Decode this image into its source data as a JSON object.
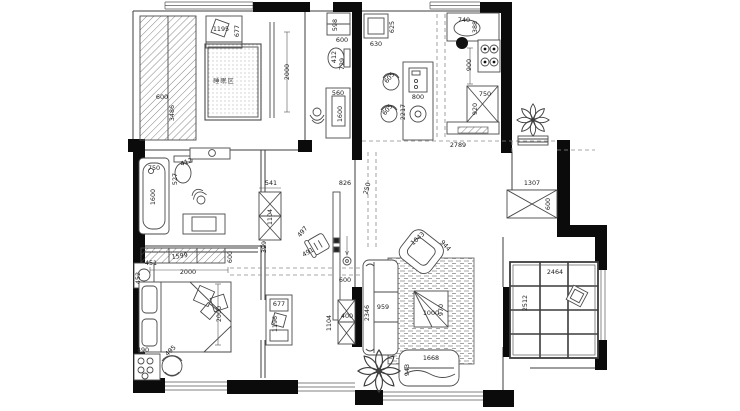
{
  "drawing": {
    "type": "apartment-floor-plan",
    "units": "mm",
    "background": "#ffffff",
    "wall_color": "#0b0b0b",
    "line_color": "#3c3c3c",
    "dashed_color": "#8a8a8a"
  },
  "room_labels": [
    {
      "text": "睡眠区",
      "x": 224,
      "y": 83,
      "rot": 0,
      "area": "bedroom-top-left"
    }
  ],
  "dimension_labels": [
    {
      "text": "1195",
      "x": 221,
      "y": 31,
      "rot": 0,
      "area": "bedroom-top-left"
    },
    {
      "text": "677",
      "x": 239,
      "y": 31,
      "rot": -90,
      "area": "bedroom-top-left"
    },
    {
      "text": "600",
      "x": 162,
      "y": 99,
      "rot": 0,
      "area": "bedroom-top-left"
    },
    {
      "text": "3486",
      "x": 174,
      "y": 113,
      "rot": -90,
      "area": "bedroom-top-left"
    },
    {
      "text": "2000",
      "x": 289,
      "y": 72,
      "rot": -90,
      "area": "bedroom-top-left"
    },
    {
      "text": "598",
      "x": 337,
      "y": 25,
      "rot": -90,
      "area": "bathroom-top"
    },
    {
      "text": "600",
      "x": 342,
      "y": 42,
      "rot": 0,
      "area": "bathroom-top"
    },
    {
      "text": "412",
      "x": 336,
      "y": 57,
      "rot": -90,
      "area": "bathroom-top"
    },
    {
      "text": "729",
      "x": 344,
      "y": 64,
      "rot": -90,
      "area": "bathroom-top"
    },
    {
      "text": "560",
      "x": 338,
      "y": 95,
      "rot": 0,
      "area": "bathroom-top"
    },
    {
      "text": "1600",
      "x": 342,
      "y": 114,
      "rot": -90,
      "area": "bathroom-top"
    },
    {
      "text": "630",
      "x": 376,
      "y": 46,
      "rot": 0,
      "area": "kitchen"
    },
    {
      "text": "625",
      "x": 394,
      "y": 27,
      "rot": -90,
      "area": "kitchen"
    },
    {
      "text": "605",
      "x": 391,
      "y": 79,
      "rot": -50,
      "area": "kitchen"
    },
    {
      "text": "605",
      "x": 389,
      "y": 111,
      "rot": -50,
      "area": "kitchen"
    },
    {
      "text": "800",
      "x": 418,
      "y": 99,
      "rot": 0,
      "area": "kitchen"
    },
    {
      "text": "2217",
      "x": 405,
      "y": 112,
      "rot": -90,
      "area": "kitchen"
    },
    {
      "text": "740",
      "x": 464,
      "y": 22,
      "rot": 0,
      "area": "kitchen"
    },
    {
      "text": "388",
      "x": 477,
      "y": 27,
      "rot": -90,
      "area": "kitchen"
    },
    {
      "text": "900",
      "x": 471,
      "y": 65,
      "rot": -90,
      "area": "kitchen"
    },
    {
      "text": "750",
      "x": 485,
      "y": 96,
      "rot": 0,
      "area": "kitchen"
    },
    {
      "text": "920",
      "x": 477,
      "y": 109,
      "rot": -90,
      "area": "kitchen"
    },
    {
      "text": "2789",
      "x": 458,
      "y": 147,
      "rot": 0,
      "area": "kitchen"
    },
    {
      "text": "1307",
      "x": 532,
      "y": 185,
      "rot": 0,
      "area": "hallway-right"
    },
    {
      "text": "600",
      "x": 550,
      "y": 204,
      "rot": -90,
      "area": "hallway-right"
    },
    {
      "text": "2464",
      "x": 555,
      "y": 274,
      "rot": 0,
      "area": "balcony"
    },
    {
      "text": "2512",
      "x": 527,
      "y": 303,
      "rot": -90,
      "area": "balcony"
    },
    {
      "text": "750",
      "x": 154,
      "y": 170,
      "rot": 0,
      "area": "bathroom-left"
    },
    {
      "text": "1600",
      "x": 155,
      "y": 197,
      "rot": -90,
      "area": "bathroom-left"
    },
    {
      "text": "412",
      "x": 187,
      "y": 164,
      "rot": -20,
      "area": "bathroom-left"
    },
    {
      "text": "527",
      "x": 177,
      "y": 179,
      "rot": -90,
      "area": "bathroom-left"
    },
    {
      "text": "541",
      "x": 271,
      "y": 185,
      "rot": 0,
      "area": "hall-center"
    },
    {
      "text": "1104",
      "x": 272,
      "y": 217,
      "rot": -90,
      "area": "hall-center"
    },
    {
      "text": "399",
      "x": 266,
      "y": 247,
      "rot": -90,
      "area": "hall-center"
    },
    {
      "text": "826",
      "x": 345,
      "y": 185,
      "rot": 0,
      "area": "hall-center"
    },
    {
      "text": "250",
      "x": 369,
      "y": 189,
      "rot": -75,
      "area": "hall-center"
    },
    {
      "text": "497",
      "x": 304,
      "y": 233,
      "rot": -50,
      "area": "hall-center"
    },
    {
      "text": "491",
      "x": 309,
      "y": 254,
      "rot": -30,
      "area": "hall-center"
    },
    {
      "text": "600",
      "x": 345,
      "y": 282,
      "rot": 0,
      "area": "hall-center"
    },
    {
      "text": "1104",
      "x": 331,
      "y": 323,
      "rot": -90,
      "area": "hall-center"
    },
    {
      "text": "400",
      "x": 347,
      "y": 318,
      "rot": 0,
      "area": "hall-center"
    },
    {
      "text": "677",
      "x": 279,
      "y": 306,
      "rot": 0,
      "area": "hall-center"
    },
    {
      "text": "1196",
      "x": 277,
      "y": 324,
      "rot": -90,
      "area": "hall-center"
    },
    {
      "text": "1599",
      "x": 180,
      "y": 258,
      "rot": -8,
      "area": "bedroom-bottom-left"
    },
    {
      "text": "600",
      "x": 232,
      "y": 257,
      "rot": -90,
      "area": "bedroom-bottom-left"
    },
    {
      "text": "451",
      "x": 151,
      "y": 265,
      "rot": 0,
      "area": "bedroom-bottom-left"
    },
    {
      "text": "452",
      "x": 140,
      "y": 278,
      "rot": -90,
      "area": "bedroom-bottom-left"
    },
    {
      "text": "2000",
      "x": 188,
      "y": 274,
      "rot": 0,
      "area": "bedroom-bottom-left"
    },
    {
      "text": "2000",
      "x": 221,
      "y": 314,
      "rot": -90,
      "area": "bedroom-bottom-left"
    },
    {
      "text": "490",
      "x": 143,
      "y": 352,
      "rot": 0,
      "area": "bedroom-bottom-left"
    },
    {
      "text": "495",
      "x": 172,
      "y": 352,
      "rot": -45,
      "area": "bedroom-bottom-left"
    },
    {
      "text": "1043",
      "x": 419,
      "y": 240,
      "rot": -42,
      "area": "living-room"
    },
    {
      "text": "944",
      "x": 444,
      "y": 247,
      "rot": 48,
      "area": "living-room"
    },
    {
      "text": "2346",
      "x": 369,
      "y": 313,
      "rot": -90,
      "area": "living-room"
    },
    {
      "text": "959",
      "x": 383,
      "y": 309,
      "rot": 0,
      "area": "living-room"
    },
    {
      "text": "1000",
      "x": 431,
      "y": 315,
      "rot": 0,
      "area": "living-room"
    },
    {
      "text": "970",
      "x": 443,
      "y": 310,
      "rot": -90,
      "area": "living-room"
    },
    {
      "text": "1668",
      "x": 431,
      "y": 360,
      "rot": 0,
      "area": "living-room"
    },
    {
      "text": "943",
      "x": 409,
      "y": 370,
      "rot": -90,
      "area": "living-room"
    }
  ]
}
